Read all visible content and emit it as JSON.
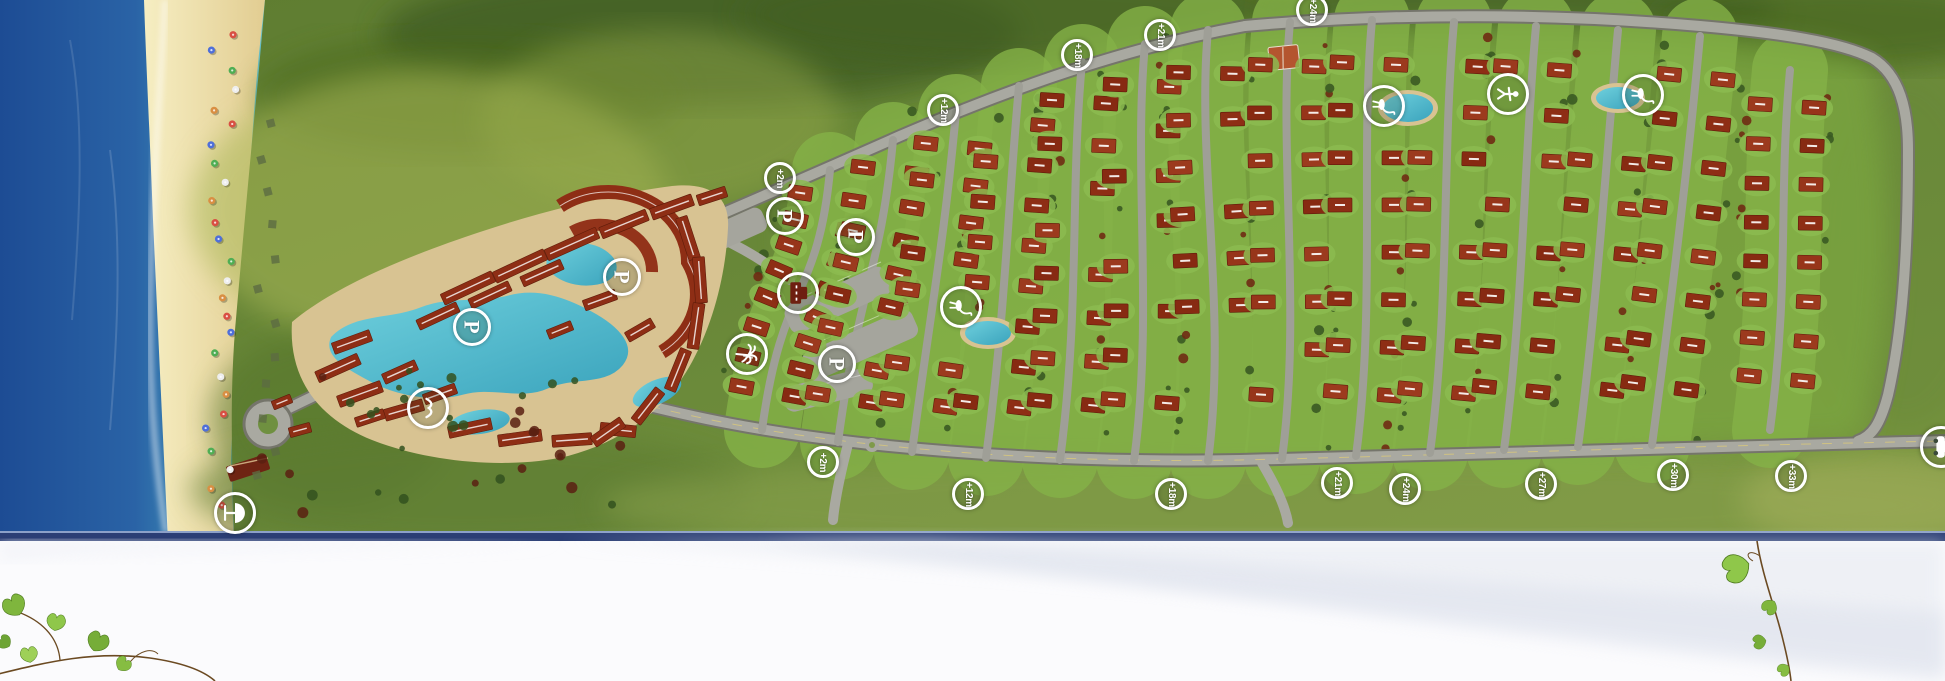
{
  "masterplan": {
    "elevation_markers": [
      {
        "label": "+2m",
        "x": 780,
        "y": 178
      },
      {
        "label": "+12m",
        "x": 943,
        "y": 110
      },
      {
        "label": "+18m",
        "x": 1077,
        "y": 55
      },
      {
        "label": "+21m",
        "x": 1160,
        "y": 35
      },
      {
        "label": "+24m",
        "x": 1312,
        "y": 10
      },
      {
        "label": "+2m",
        "x": 823,
        "y": 462
      },
      {
        "label": "+12m",
        "x": 968,
        "y": 494
      },
      {
        "label": "+18m",
        "x": 1171,
        "y": 494
      },
      {
        "label": "+21m",
        "x": 1337,
        "y": 483
      },
      {
        "label": "+24m",
        "x": 1405,
        "y": 489
      },
      {
        "label": "+27m",
        "x": 1541,
        "y": 484
      },
      {
        "label": "+30m",
        "x": 1673,
        "y": 475
      },
      {
        "label": "+33m",
        "x": 1791,
        "y": 476
      }
    ],
    "parking_markers": [
      {
        "label": "P",
        "x": 472,
        "y": 327
      },
      {
        "label": "P",
        "x": 622,
        "y": 277
      },
      {
        "label": "P",
        "x": 785,
        "y": 216
      },
      {
        "label": "P",
        "x": 856,
        "y": 237
      },
      {
        "label": "P",
        "x": 837,
        "y": 364
      }
    ],
    "amenity_markers": [
      {
        "icon": "seagull",
        "x": 428,
        "y": 408
      },
      {
        "icon": "beach-umbrella",
        "x": 235,
        "y": 513
      },
      {
        "icon": "palm-tree",
        "x": 747,
        "y": 354
      },
      {
        "icon": "hotel-building",
        "x": 798,
        "y": 293
      },
      {
        "icon": "water-bird",
        "x": 961,
        "y": 307
      },
      {
        "icon": "water-bird",
        "x": 1384,
        "y": 106
      },
      {
        "icon": "playground-figure",
        "x": 1508,
        "y": 94
      },
      {
        "icon": "water-bird",
        "x": 1643,
        "y": 95
      },
      {
        "icon": "entrance-car",
        "x": 1941,
        "y": 447
      }
    ],
    "colors": {
      "sea_deep": "#1d4c94",
      "sea_shallow": "#8fd8d0",
      "sand": "#ecd9a0",
      "land": "#6b8a3a",
      "villa_lawn": "#84b247",
      "roof": "#8e2e15",
      "pool": "#4db5c8",
      "road": "#9f9f97",
      "footer_border": "#2b3e75",
      "footer_bg": "#fbfbfd",
      "vine_leaf": "#84bc3f"
    }
  }
}
